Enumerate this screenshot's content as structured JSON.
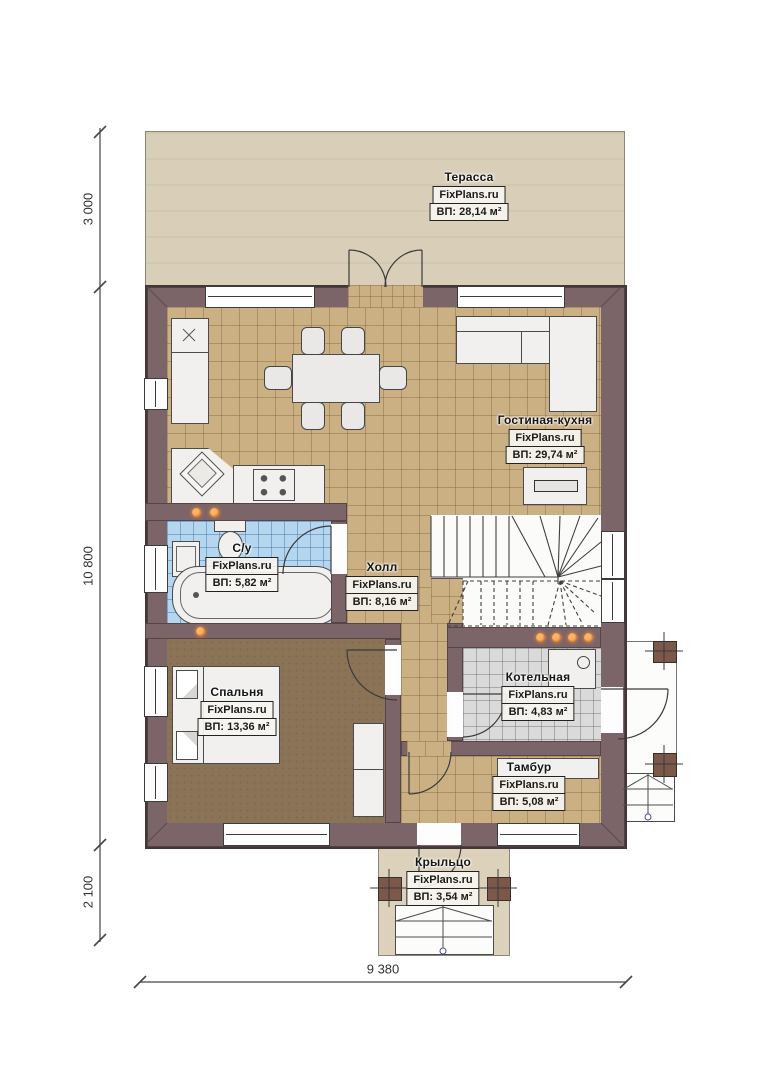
{
  "watermark": "FixPlans.ru",
  "dimensions": {
    "left_top": "3 000",
    "left_middle": "10 800",
    "left_bottom": "2 100",
    "bottom": "9 380"
  },
  "rooms": {
    "terrace": {
      "name": "Терасса",
      "area": "ВП: 28,14 м²"
    },
    "living": {
      "name": "Гостиная-кухня",
      "area": "ВП: 29,74 м²"
    },
    "bath": {
      "name": "С/у",
      "area": "ВП: 5,82 м²"
    },
    "hall": {
      "name": "Холл",
      "area": "ВП: 8,16 м²"
    },
    "bedroom": {
      "name": "Спальня",
      "area": "ВП: 13,36 м²"
    },
    "boiler": {
      "name": "Котельная",
      "area": "ВП: 4,83 м²"
    },
    "tambour": {
      "name": "Тамбур",
      "area": "ВП: 5,08 м²"
    },
    "porch": {
      "name": "Крыльцо",
      "area": "ВП: 3,54 м²"
    }
  },
  "colors": {
    "wall": "#7b6568",
    "floor_tile": "#cbb084",
    "bath_tile": "#b5d6ef",
    "boiler_tile": "#dadada",
    "bedroom_floor": "#8a7356",
    "terrace_floor": "#d9cfb9",
    "porch_floor": "#dcd2bb",
    "lamp": "#e07a23"
  }
}
